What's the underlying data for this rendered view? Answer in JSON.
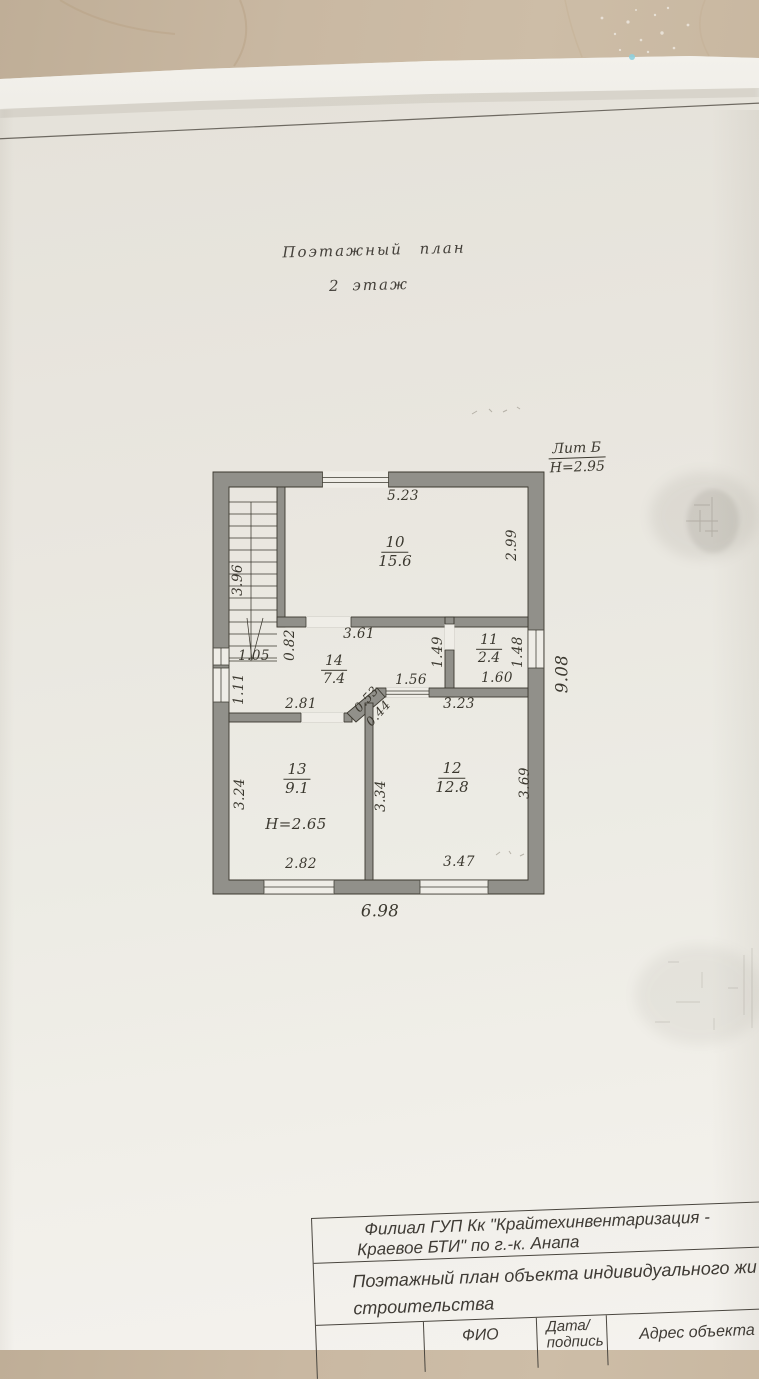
{
  "colors": {
    "wall_gray": "#91908a",
    "ink": "#3b382f",
    "text_ink": "#3b382f",
    "paper": "#ebe8e1",
    "table_bg": "#c9b8a2"
  },
  "header": {
    "title": "Поэтажный план",
    "subtitle": "2 этаж"
  },
  "lit": {
    "name": "Лит Б",
    "height": "Н=2.95"
  },
  "plan": {
    "rooms": {
      "r10": {
        "num": "10",
        "area": "15.6"
      },
      "r11": {
        "num": "11",
        "area": "2.4"
      },
      "r12": {
        "num": "12",
        "area": "12.8"
      },
      "r13": {
        "num": "13",
        "area": "9.1"
      },
      "r14": {
        "num": "14",
        "area": "7.4"
      }
    },
    "room13_height": "Н=2.65",
    "dims": {
      "room10_width": "5.23",
      "room10_side": "2.99",
      "stairs_length": "3.96",
      "stairs_width": "1.05",
      "stairs_offset": "0.82",
      "corridor_width": "3.61",
      "room11_side_left": "1.49",
      "room11_side_right": "1.48",
      "corridor_niche": "1.56",
      "room11_width": "1.60",
      "wall_pier": "1.11",
      "room13_top": "2.81",
      "diag_upper": "0.53",
      "diag_lower": "0.44",
      "room12_top": "3.23",
      "room13_side": "3.24",
      "partition": "3.34",
      "room12_side": "3.69",
      "room13_bottom": "2.82",
      "room12_bottom": "3.47",
      "building_width": "6.98",
      "building_depth": "9.08"
    }
  },
  "title_block": {
    "org_line1": "Филиал ГУП Кк \"Крайтехинвентаризация -",
    "org_line2": "Краевое БТИ\" по г.-к. Анапа",
    "doc_line1": "Поэтажный план объекта индивидуального жи",
    "doc_line2": "строительства",
    "col_fio": "ФИО",
    "col_date_line1": "Дата/",
    "col_date_line2": "подпись",
    "col_address": "Адрес объекта"
  }
}
